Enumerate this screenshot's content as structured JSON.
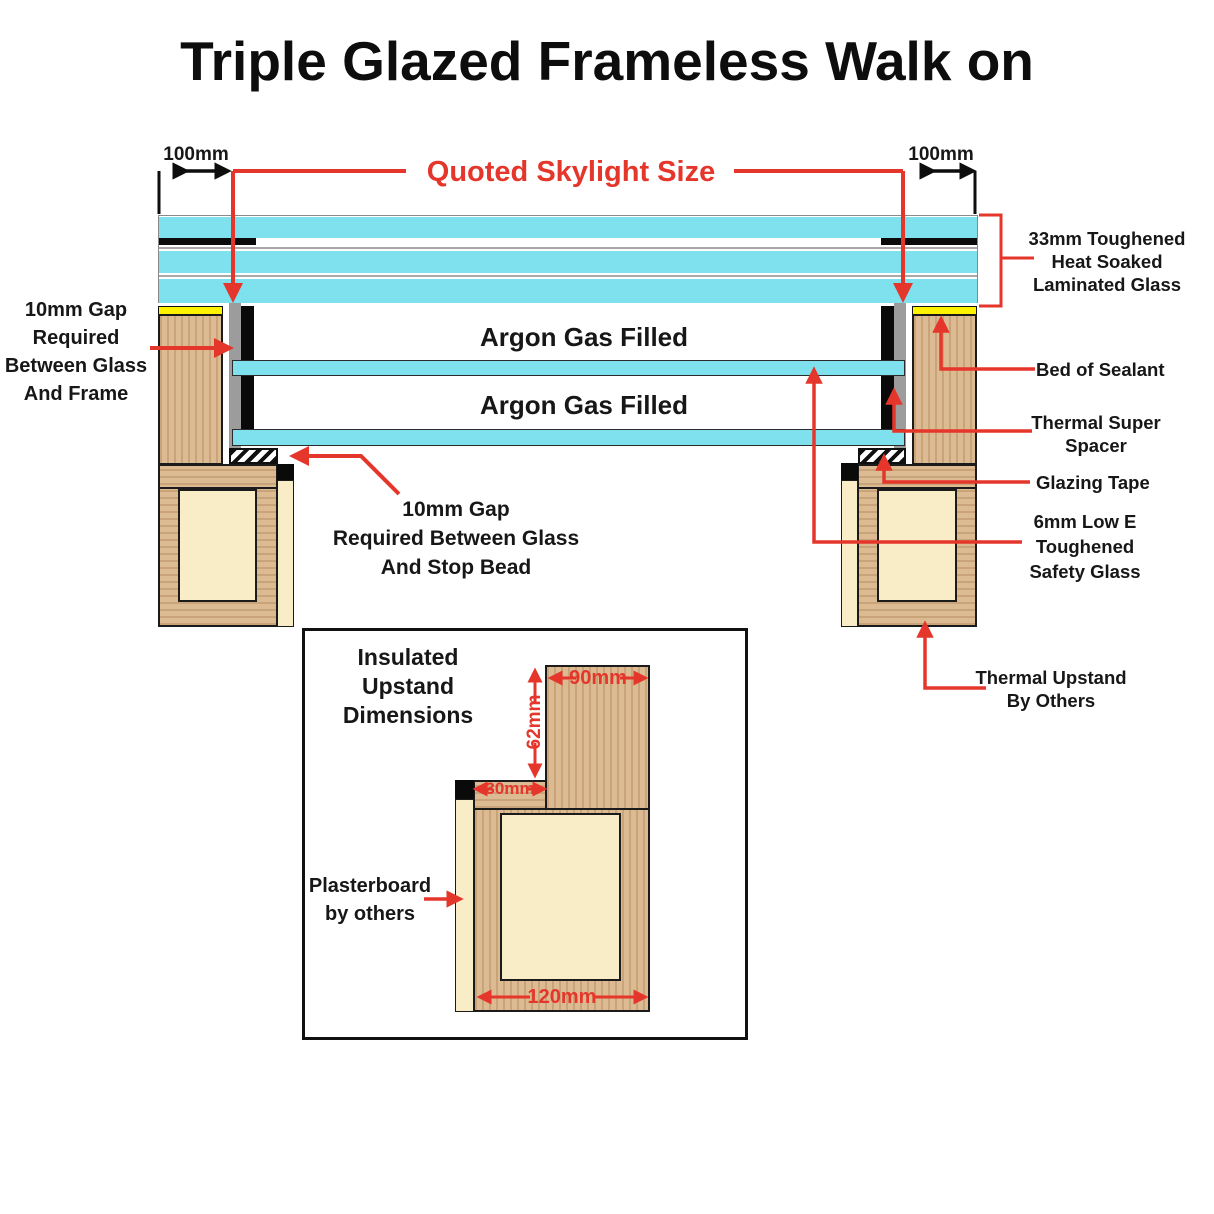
{
  "title": "Triple Glazed Frameless Walk on",
  "dimensions": {
    "left_overhang": "100mm",
    "right_overhang": "100mm",
    "quoted": "Quoted Skylight Size"
  },
  "glass": {
    "argon1": "Argon Gas Filled",
    "argon2": "Argon Gas Filled"
  },
  "labels": {
    "gap_frame": [
      "10mm Gap",
      "Required",
      "Between Glass",
      "And Frame"
    ],
    "gap_stop_bead": [
      "10mm Gap",
      "Required Between Glass",
      "And Stop Bead"
    ],
    "toughened": [
      "33mm Toughened",
      "Heat Soaked",
      "Laminated Glass"
    ],
    "bed_of_sealant": "Bed of Sealant",
    "thermal_spacer": [
      "Thermal Super",
      "Spacer"
    ],
    "glazing_tape": "Glazing Tape",
    "low_e": [
      "6mm Low E",
      "Toughened",
      "Safety Glass"
    ],
    "thermal_upstand": [
      "Thermal Upstand",
      "By Others"
    ]
  },
  "inset": {
    "title": [
      "Insulated Upstand",
      "Dimensions"
    ],
    "dim_90": "90mm",
    "dim_62": "62mm",
    "dim_30": "30mm",
    "dim_120": "120mm",
    "plasterboard": [
      "Plasterboard",
      "by others"
    ]
  },
  "colors": {
    "glass": "#7FE1EE",
    "wood": "#DDBB92",
    "cream": "#F8EDC7",
    "sealant_yellow": "#FFF200",
    "spacer_gray": "#9C9C9C",
    "accent_red": "#E5362B"
  }
}
